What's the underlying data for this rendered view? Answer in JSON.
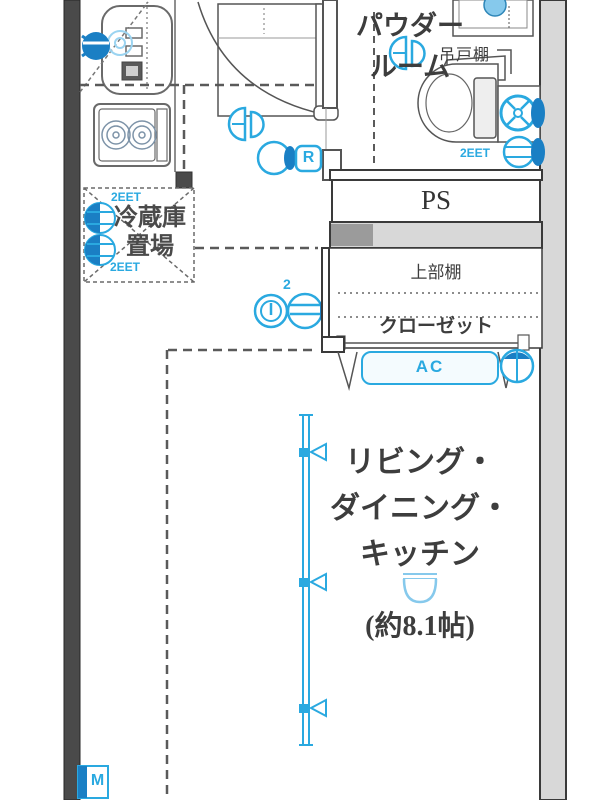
{
  "plan": {
    "title": "apartment floor plan",
    "powder_room_label": "パウダー\nルーム",
    "hanging_cabinet_label": "吊戸棚",
    "ps_label": "PS",
    "upper_shelf_label": "上部棚",
    "closet_label": "クローゼット",
    "ac_label": "AC",
    "fridge_label": "冷蔵庫\n置場",
    "ldk_label": "リビング・\nダイニング・\nキッチン",
    "ldk_size_label": "(約8.1帖)",
    "outlet_fridge_top": "2EET",
    "outlet_fridge_bottom": "2EET",
    "outlet_laundry": "2EET",
    "outlet_count": "2",
    "r_badge": "R",
    "m_badge": "M"
  },
  "colors": {
    "accent_blue": "#2aa9e0",
    "deep_blue": "#1a7fc4",
    "light_blue": "#86c9ec",
    "line_dark": "#4a4a4a",
    "wall_gray": "#d8d8d8",
    "text_dark": "#3d3d3d"
  },
  "icons": [
    "kitchen-faucet-icon",
    "water-spray-icon",
    "stove-burner-icon",
    "ceiling-light-icon",
    "double-outlet-icon",
    "intercom-ring-icon",
    "outlet-arrow-icon",
    "doorbell-r-icon",
    "washing-machine-icon",
    "laundry-faucet-icon",
    "vanity-faucet-icon",
    "ac-outlet-icon",
    "window-handle-icon",
    "meter-m-icon"
  ]
}
